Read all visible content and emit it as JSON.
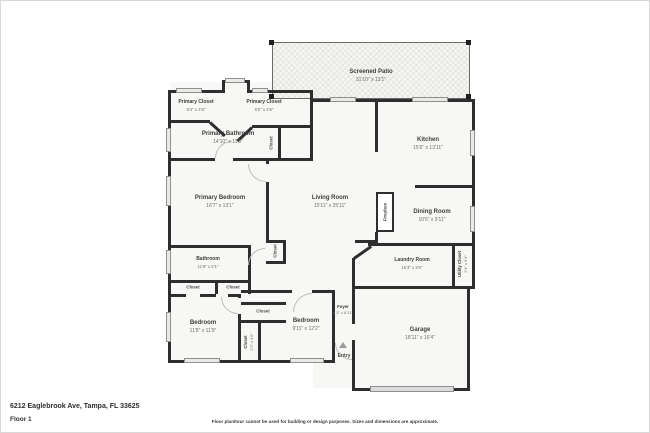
{
  "rooms": [
    {
      "name": "Screened Patio",
      "dims": "31'10\" x 13'1\""
    },
    {
      "name": "Primary Closet",
      "dims": "5'4\" x 4'5\""
    },
    {
      "name": "Primary Closet",
      "dims": "5'5\" x 4'5\""
    },
    {
      "name": "Primary Bathroom",
      "dims": "14'10\" x 11'5\""
    },
    {
      "name": "Kitchen",
      "dims": "15'6\" x 13'11\""
    },
    {
      "name": "Living Room",
      "dims": "15'11\" x 25'11\""
    },
    {
      "name": "Dining Room",
      "dims": "10'6\" x 9'11\""
    },
    {
      "name": "Primary Bedroom",
      "dims": "16'7\" x 13'1\""
    },
    {
      "name": "Bathroom",
      "dims": "11'8\" x 5'1\""
    },
    {
      "name": "Laundry Room",
      "dims": "16'3\" x 5'6\""
    },
    {
      "name": "Utility Closet",
      "dims": "2'4\" x 5'4\""
    },
    {
      "name": "Bedroom",
      "dims": "11'8\" x 11'9\""
    },
    {
      "name": "Bedroom",
      "dims": "9'11\" x 12'2\""
    },
    {
      "name": "Foyer",
      "dims": "4'3\" x 8'11\""
    },
    {
      "name": "Garage",
      "dims": "18'11\" x 16'4\""
    },
    {
      "name": "Closet",
      "dims": "2'2\" x 4'9\""
    }
  ],
  "labels": {
    "closet": "Closet",
    "fireplace": "Fireplace",
    "entry": "Entry"
  },
  "footer": {
    "address": "6212 Eaglebrook Ave, Tampa, FL 33625",
    "floor_label": "Floor 1",
    "disclaimer": "Floor plan/tour cannot be used for building or design purposes. Sizes and dimensions are approximate."
  },
  "colors": {
    "wall": "#2e2e2e",
    "window": "#eceae7",
    "patio_fill": "#f5f5f2",
    "room_fill": "#f7f7f5",
    "text": "#3d3d3d"
  }
}
